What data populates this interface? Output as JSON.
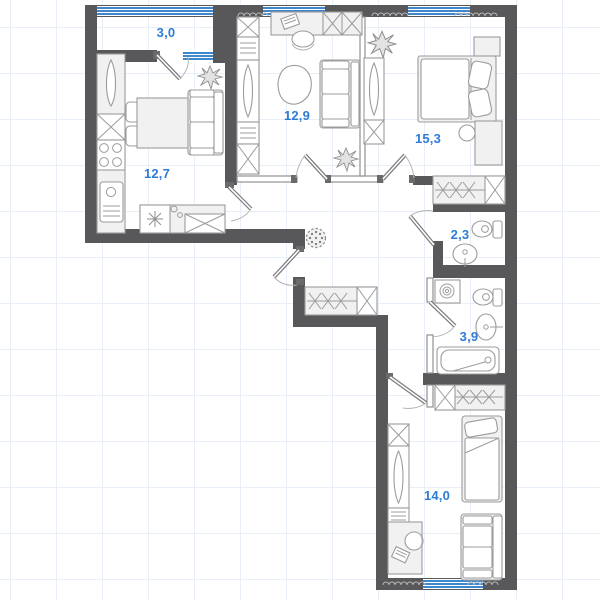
{
  "plan": {
    "type": "apartment-floor-plan",
    "rooms": [
      {
        "key": "balcony",
        "area": "3,0"
      },
      {
        "key": "kitchen-living",
        "area": "12,7"
      },
      {
        "key": "living-room",
        "area": "12,9"
      },
      {
        "key": "bedroom-1",
        "area": "15,3"
      },
      {
        "key": "wc",
        "area": "2,3"
      },
      {
        "key": "bathroom",
        "area": "3,9"
      },
      {
        "key": "bedroom-2",
        "area": "14,0"
      }
    ],
    "colors": {
      "wall": "#58585a",
      "label": "#2e7cd6",
      "window": "#3f87cd",
      "furniture_stroke": "#9c9c9c",
      "furniture_fill": "#f1f1f1",
      "grid": "#e9eff8",
      "background": "#ffffff"
    },
    "symbols": {
      "window": "blue-striped-band",
      "hanger-rail": "bowtie-triangles",
      "wardrobe-section": "crossed-box",
      "washing-machine": "box-with-spiral",
      "pouf": "dotted-circle"
    }
  }
}
